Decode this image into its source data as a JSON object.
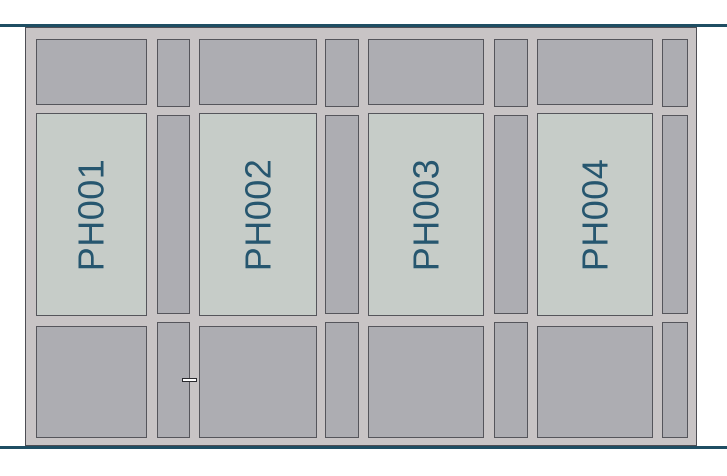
{
  "drawing": {
    "panels": [
      {
        "label": "PH001"
      },
      {
        "label": "PH002"
      },
      {
        "label": "PH003"
      },
      {
        "label": "PH004"
      }
    ],
    "colors": {
      "accent_line": "#1F4E63",
      "frame_mullion_gray": "#C8C4C5",
      "solid_panel_gray": "#ADADB2",
      "glass_panel_gray_green": "#C6CCC8",
      "outline_dark": "#55555B",
      "label_text": "#26566F",
      "door_handle_fill": "#FFFFFF"
    }
  }
}
